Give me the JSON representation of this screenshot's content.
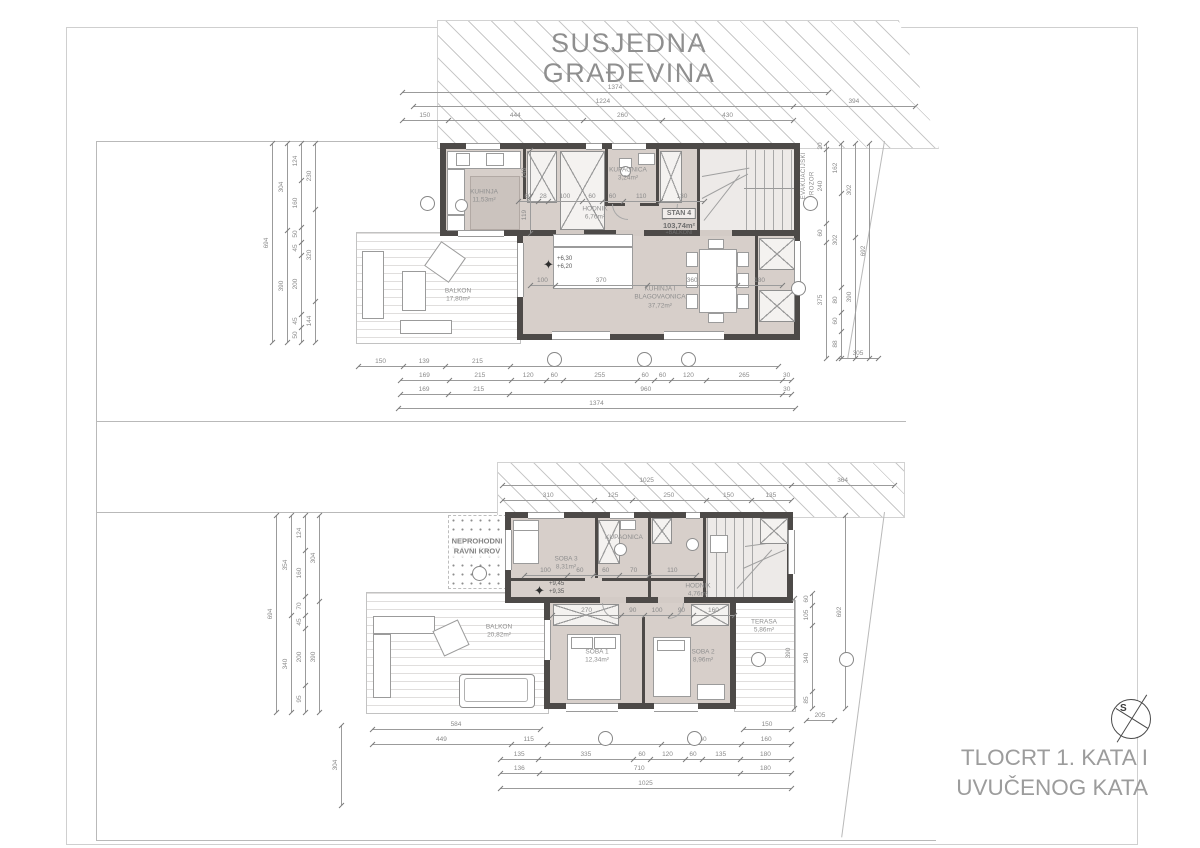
{
  "neighbor_building": {
    "line1": "SUSJEDNA",
    "line2": "GRAĐEVINA"
  },
  "title_block": {
    "line1": "TLOCRT 1. KATA I",
    "line2": "UVUČENOG KATA"
  },
  "compass": {
    "letter": "S"
  },
  "colors": {
    "wall": "#4d4a48",
    "floor": "#d7cfca",
    "dim_text": "#8a8a8a",
    "label_text": "#8f8f8f",
    "title_text": "#9c9c9c"
  },
  "plans": [
    {
      "id": "plan1",
      "unit_label": {
        "x": 679,
        "y": 219,
        "lines": [
          "STAN 4",
          "103,74m²",
          "+BALKONI"
        ]
      },
      "labels": [
        {
          "x": 484,
          "y": 197,
          "lines": [
            "KUHINJA",
            "11,53m²"
          ]
        },
        {
          "x": 595,
          "y": 214,
          "lines": [
            "HODNIK",
            "6,76m²"
          ]
        },
        {
          "x": 628,
          "y": 175,
          "lines": [
            "KUPAONICA",
            "3,24m²"
          ]
        },
        {
          "x": 660,
          "y": 298,
          "lines": [
            "KUHINJA I",
            "BLAGOVAONICA",
            "37,72m²"
          ]
        },
        {
          "x": 458,
          "y": 296,
          "lines": [
            "BALKON",
            "17,80m²"
          ]
        }
      ],
      "elevation": {
        "x": 557,
        "y": 256,
        "star_x": 543,
        "star_y": 258,
        "lines": [
          "+6,30",
          "+6,20"
        ]
      },
      "note": {
        "x": 800,
        "y": 152,
        "text": "EVAKUACIJSKI\nPROZOR"
      }
    },
    {
      "id": "plan2",
      "roof_label": {
        "x": 477,
        "y": 546,
        "lines": [
          "NEPROHODNI",
          "RAVNI KROV"
        ]
      },
      "labels": [
        {
          "x": 566,
          "y": 564,
          "lines": [
            "SOBA 3",
            "8,31m²"
          ]
        },
        {
          "x": 624,
          "y": 538,
          "lines": [
            "KUPAONICA"
          ]
        },
        {
          "x": 698,
          "y": 591,
          "lines": [
            "HODNIK",
            "4,76m²"
          ]
        },
        {
          "x": 597,
          "y": 657,
          "lines": [
            "SOBA 1",
            "12,34m²"
          ]
        },
        {
          "x": 703,
          "y": 657,
          "lines": [
            "SOBA 2",
            "8,96m²"
          ]
        },
        {
          "x": 764,
          "y": 627,
          "lines": [
            "TERASA",
            "5,86m²"
          ]
        },
        {
          "x": 499,
          "y": 632,
          "lines": [
            "BALKON",
            "20,82m²"
          ]
        }
      ],
      "elevation": {
        "x": 549,
        "y": 581,
        "star_x": 534,
        "star_y": 584,
        "lines": [
          "+9,45",
          "+9,35"
        ]
      },
      "note": null
    }
  ],
  "dims": [
    {
      "vert": false,
      "x": 402,
      "y": 92,
      "len": 426,
      "v": [
        1374
      ]
    },
    {
      "vert": false,
      "x": 413,
      "y": 106,
      "len": 502,
      "v": [
        1224,
        394
      ]
    },
    {
      "vert": false,
      "x": 402,
      "y": 120,
      "len": 391,
      "v": [
        150,
        444,
        260,
        430
      ]
    },
    {
      "vert": false,
      "x": 358,
      "y": 366,
      "len": 420,
      "v": [
        150,
        139,
        215,
        890
      ]
    },
    {
      "vert": false,
      "x": 400,
      "y": 380,
      "len": 391,
      "v": [
        169,
        215,
        120,
        60,
        255,
        60,
        60,
        120,
        265,
        30
      ]
    },
    {
      "vert": false,
      "x": 400,
      "y": 394,
      "len": 391,
      "v": [
        169,
        215,
        960,
        30
      ]
    },
    {
      "vert": false,
      "x": 398,
      "y": 408,
      "len": 397,
      "v": [
        1374
      ]
    },
    {
      "vert": true,
      "x": 272,
      "y": 143,
      "len": 199,
      "v": [
        694
      ]
    },
    {
      "vert": true,
      "x": 287,
      "y": 143,
      "len": 199,
      "v": [
        304,
        390
      ]
    },
    {
      "vert": true,
      "x": 301,
      "y": 143,
      "len": 199,
      "v": [
        124,
        160,
        50,
        45,
        200,
        45,
        50
      ]
    },
    {
      "vert": true,
      "x": 315,
      "y": 143,
      "len": 199,
      "v": [
        230,
        320,
        144
      ]
    },
    {
      "vert": true,
      "x": 826,
      "y": 143,
      "len": 215,
      "v": [
        20,
        240,
        60,
        375
      ]
    },
    {
      "vert": true,
      "x": 841,
      "y": 143,
      "len": 215,
      "v": [
        162,
        302,
        80,
        60,
        88
      ]
    },
    {
      "vert": true,
      "x": 855,
      "y": 143,
      "len": 215,
      "v": [
        302,
        390
      ]
    },
    {
      "vert": true,
      "x": 869,
      "y": 143,
      "len": 215,
      "v": [
        692
      ]
    },
    {
      "vert": false,
      "x": 838,
      "y": 358,
      "len": 40,
      "v": [
        305
      ]
    },
    {
      "vert": false,
      "x": 518,
      "y": 201,
      "len": 186,
      "v": [
        60,
        28,
        100,
        60,
        60,
        110,
        130
      ]
    },
    {
      "vert": false,
      "x": 530,
      "y": 285,
      "len": 252,
      "v": [
        100,
        370,
        360,
        180
      ]
    },
    {
      "vert": true,
      "x": 530,
      "y": 150,
      "len": 83,
      "v": [
        148,
        119
      ]
    },
    {
      "vert": false,
      "x": 502,
      "y": 485,
      "len": 392,
      "v": [
        1025,
        364
      ]
    },
    {
      "vert": false,
      "x": 502,
      "y": 500,
      "len": 289,
      "v": [
        310,
        125,
        250,
        150,
        135
      ]
    },
    {
      "vert": true,
      "x": 276,
      "y": 515,
      "len": 197,
      "v": [
        694
      ]
    },
    {
      "vert": true,
      "x": 291,
      "y": 515,
      "len": 197,
      "v": [
        354,
        340
      ]
    },
    {
      "vert": true,
      "x": 305,
      "y": 515,
      "len": 197,
      "v": [
        124,
        160,
        70,
        45,
        200,
        95
      ]
    },
    {
      "vert": true,
      "x": 319,
      "y": 515,
      "len": 197,
      "v": [
        304,
        390
      ]
    },
    {
      "vert": true,
      "x": 794,
      "y": 598,
      "len": 110,
      "v": [
        390
      ]
    },
    {
      "vert": true,
      "x": 812,
      "y": 593,
      "len": 115,
      "v": [
        60,
        105,
        340,
        85
      ]
    },
    {
      "vert": true,
      "x": 845,
      "y": 515,
      "len": 193,
      "v": [
        692
      ]
    },
    {
      "vert": false,
      "x": 806,
      "y": 720,
      "len": 28,
      "v": [
        205
      ]
    },
    {
      "vert": false,
      "x": 524,
      "y": 575,
      "len": 172,
      "v": [
        100,
        60,
        60,
        70,
        110
      ]
    },
    {
      "vert": false,
      "x": 552,
      "y": 615,
      "len": 182,
      "v": [
        270,
        90,
        100,
        90,
        160
      ]
    },
    {
      "vert": false,
      "x": 372,
      "y": 729,
      "len": 168,
      "v": [
        584
      ]
    },
    {
      "vert": false,
      "x": 743,
      "y": 729,
      "len": 48,
      "v": [
        150
      ]
    },
    {
      "vert": false,
      "x": 372,
      "y": 744,
      "len": 419,
      "v": [
        449,
        115,
        370,
        260,
        160
      ]
    },
    {
      "vert": false,
      "x": 500,
      "y": 759,
      "len": 291,
      "v": [
        135,
        335,
        60,
        120,
        60,
        135,
        180
      ]
    },
    {
      "vert": false,
      "x": 500,
      "y": 773,
      "len": 291,
      "v": [
        136,
        710,
        180
      ]
    },
    {
      "vert": false,
      "x": 500,
      "y": 788,
      "len": 291,
      "v": [
        1025
      ]
    },
    {
      "vert": true,
      "x": 341,
      "y": 725,
      "len": 80,
      "v": [
        304
      ]
    }
  ],
  "markers": [
    {
      "x": 426,
      "y": 202
    },
    {
      "x": 809,
      "y": 202
    },
    {
      "x": 797,
      "y": 287
    },
    {
      "x": 553,
      "y": 358
    },
    {
      "x": 643,
      "y": 358
    },
    {
      "x": 687,
      "y": 358
    },
    {
      "x": 478,
      "y": 572
    },
    {
      "x": 757,
      "y": 658
    },
    {
      "x": 845,
      "y": 658
    },
    {
      "x": 604,
      "y": 737
    },
    {
      "x": 693,
      "y": 737
    }
  ]
}
